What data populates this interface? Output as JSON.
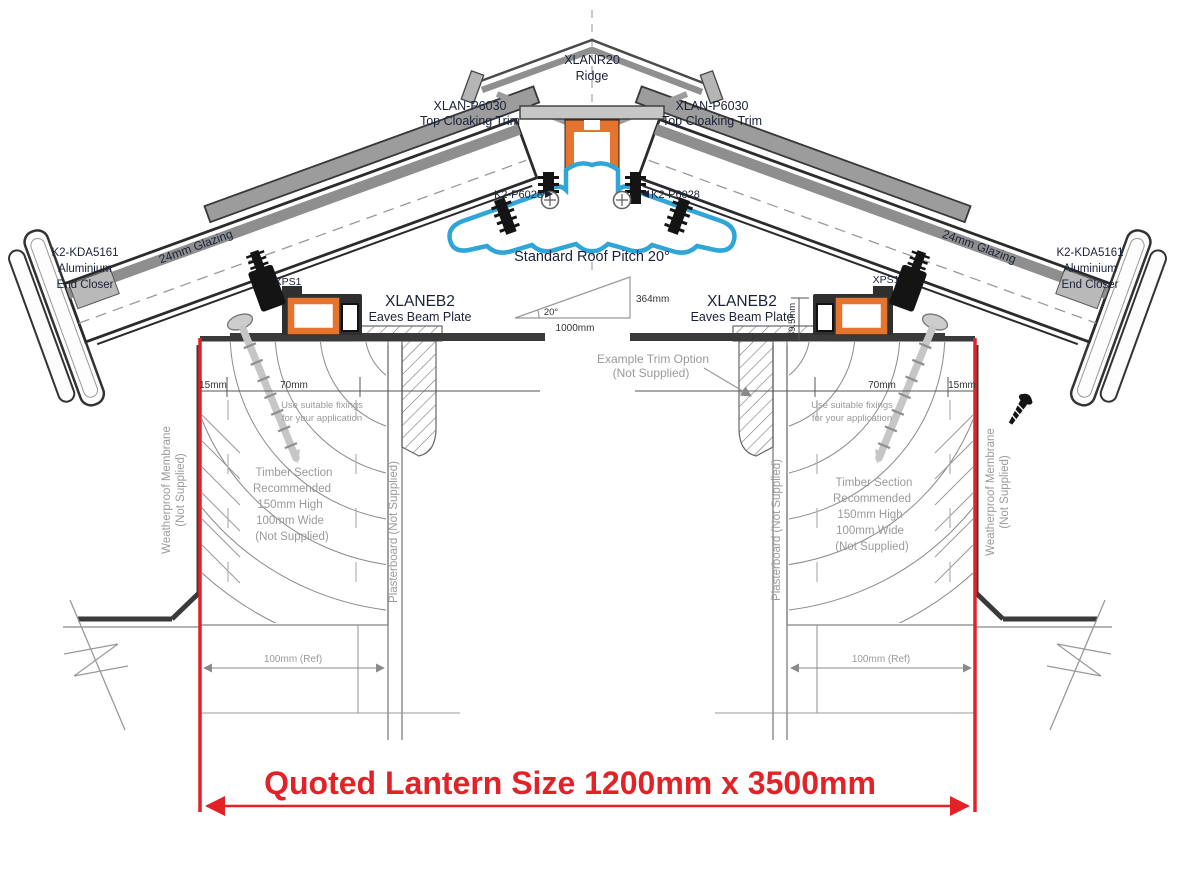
{
  "colors": {
    "highlight_red": "#e32227",
    "profile_orange": "#e5742e",
    "profile_blue": "#2fa5d8",
    "note_gray": "#9a9a9a",
    "line_dark": "#3a3a3a"
  },
  "ridge": {
    "part": "XLANR20",
    "label": "Ridge"
  },
  "top_cloaking_trim": {
    "part": "XLAN-P6030",
    "label": "Top Cloaking Trim"
  },
  "ridge_fixing": {
    "part": "K2-P6028"
  },
  "roof_pitch": {
    "label": "Standard Roof Pitch 20°",
    "angle": "20°",
    "run": "1000mm",
    "rise": "364mm"
  },
  "eaves_beam": {
    "part": "XLANEB2",
    "label": "Eaves Beam Plate"
  },
  "insulator": {
    "part": "XPS1"
  },
  "glazing": {
    "label": "24mm Glazing"
  },
  "end_closer": {
    "part": "K2-KDA5161",
    "line2": "Aluminium",
    "line3": "End Closer"
  },
  "dims": {
    "edge": "15mm",
    "fixing_zone": "70mm",
    "beam_height": "39.5mm",
    "wall_ref": "100mm (Ref)"
  },
  "notes": {
    "fixings_line1": "Use suitable fixings",
    "fixings_line2": "for your application",
    "timber_line1": "Timber Section",
    "timber_line2": "Recommended",
    "timber_line3": "150mm High",
    "timber_line4": "100mm Wide",
    "timber_line5": "(Not Supplied)",
    "membrane_line1": "Weatherproof Membrane",
    "membrane_line2": "(Not Supplied)",
    "plasterboard": "Plasterboard (Not Supplied)",
    "trim_option_line1": "Example  Trim Option",
    "trim_option_line2": "(Not Supplied)"
  },
  "quoted_size": {
    "label": "Quoted Lantern Size 1200mm x 3500mm"
  }
}
